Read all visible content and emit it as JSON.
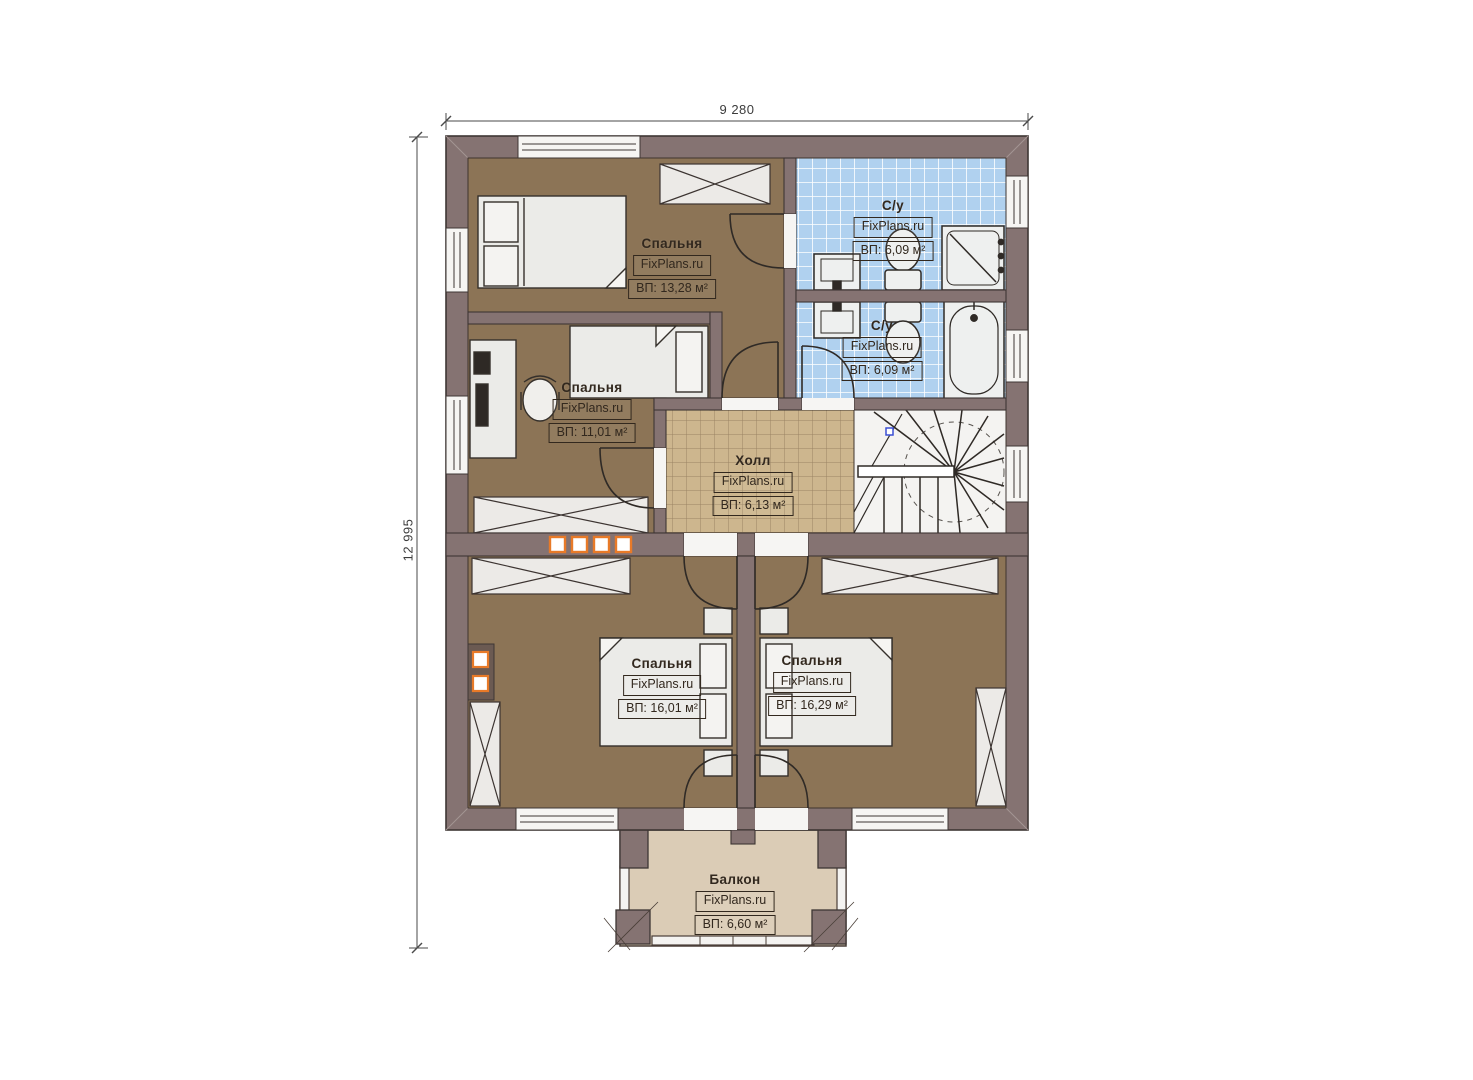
{
  "plan": {
    "type": "apartment floor plan, second storey",
    "watermark": "FixPlans.ru"
  },
  "dimensions": {
    "width_label": "9 280",
    "height_label": "12 995"
  },
  "rooms": [
    {
      "key": "bedroom-top-left",
      "name": "Спальня",
      "watermark": "FixPlans.ru",
      "area": "ВП: 13,28 м²"
    },
    {
      "key": "bedroom-mid-left",
      "name": "Спальня",
      "watermark": "FixPlans.ru",
      "area": "ВП: 11,01 м²"
    },
    {
      "key": "bathroom-upper",
      "name": "С/у",
      "watermark": "FixPlans.ru",
      "area": "ВП: 6,09 м²"
    },
    {
      "key": "bathroom-lower",
      "name": "С/у",
      "watermark": "FixPlans.ru",
      "area": "ВП: 6,09 м²"
    },
    {
      "key": "hall",
      "name": "Холл",
      "watermark": "FixPlans.ru",
      "area": "ВП: 6,13 м²"
    },
    {
      "key": "bedroom-bottom-left",
      "name": "Спальня",
      "watermark": "FixPlans.ru",
      "area": "ВП: 16,01 м²"
    },
    {
      "key": "bedroom-bottom-right",
      "name": "Спальня",
      "watermark": "FixPlans.ru",
      "area": "ВП: 16,29 м²"
    },
    {
      "key": "balcony",
      "name": "Балкон",
      "watermark": "FixPlans.ru",
      "area": "ВП: 6,60 м²"
    }
  ],
  "colors": {
    "wall": "#857372",
    "wall_outline": "#3e3634",
    "bedroom_floor": "#8c7456",
    "hall_tile": "#cdb68e",
    "bath_tile": "#b0d1ef",
    "balcony_floor": "#dbccb6",
    "furniture": "#ebebe8",
    "accent_orange": "#e87a28"
  }
}
